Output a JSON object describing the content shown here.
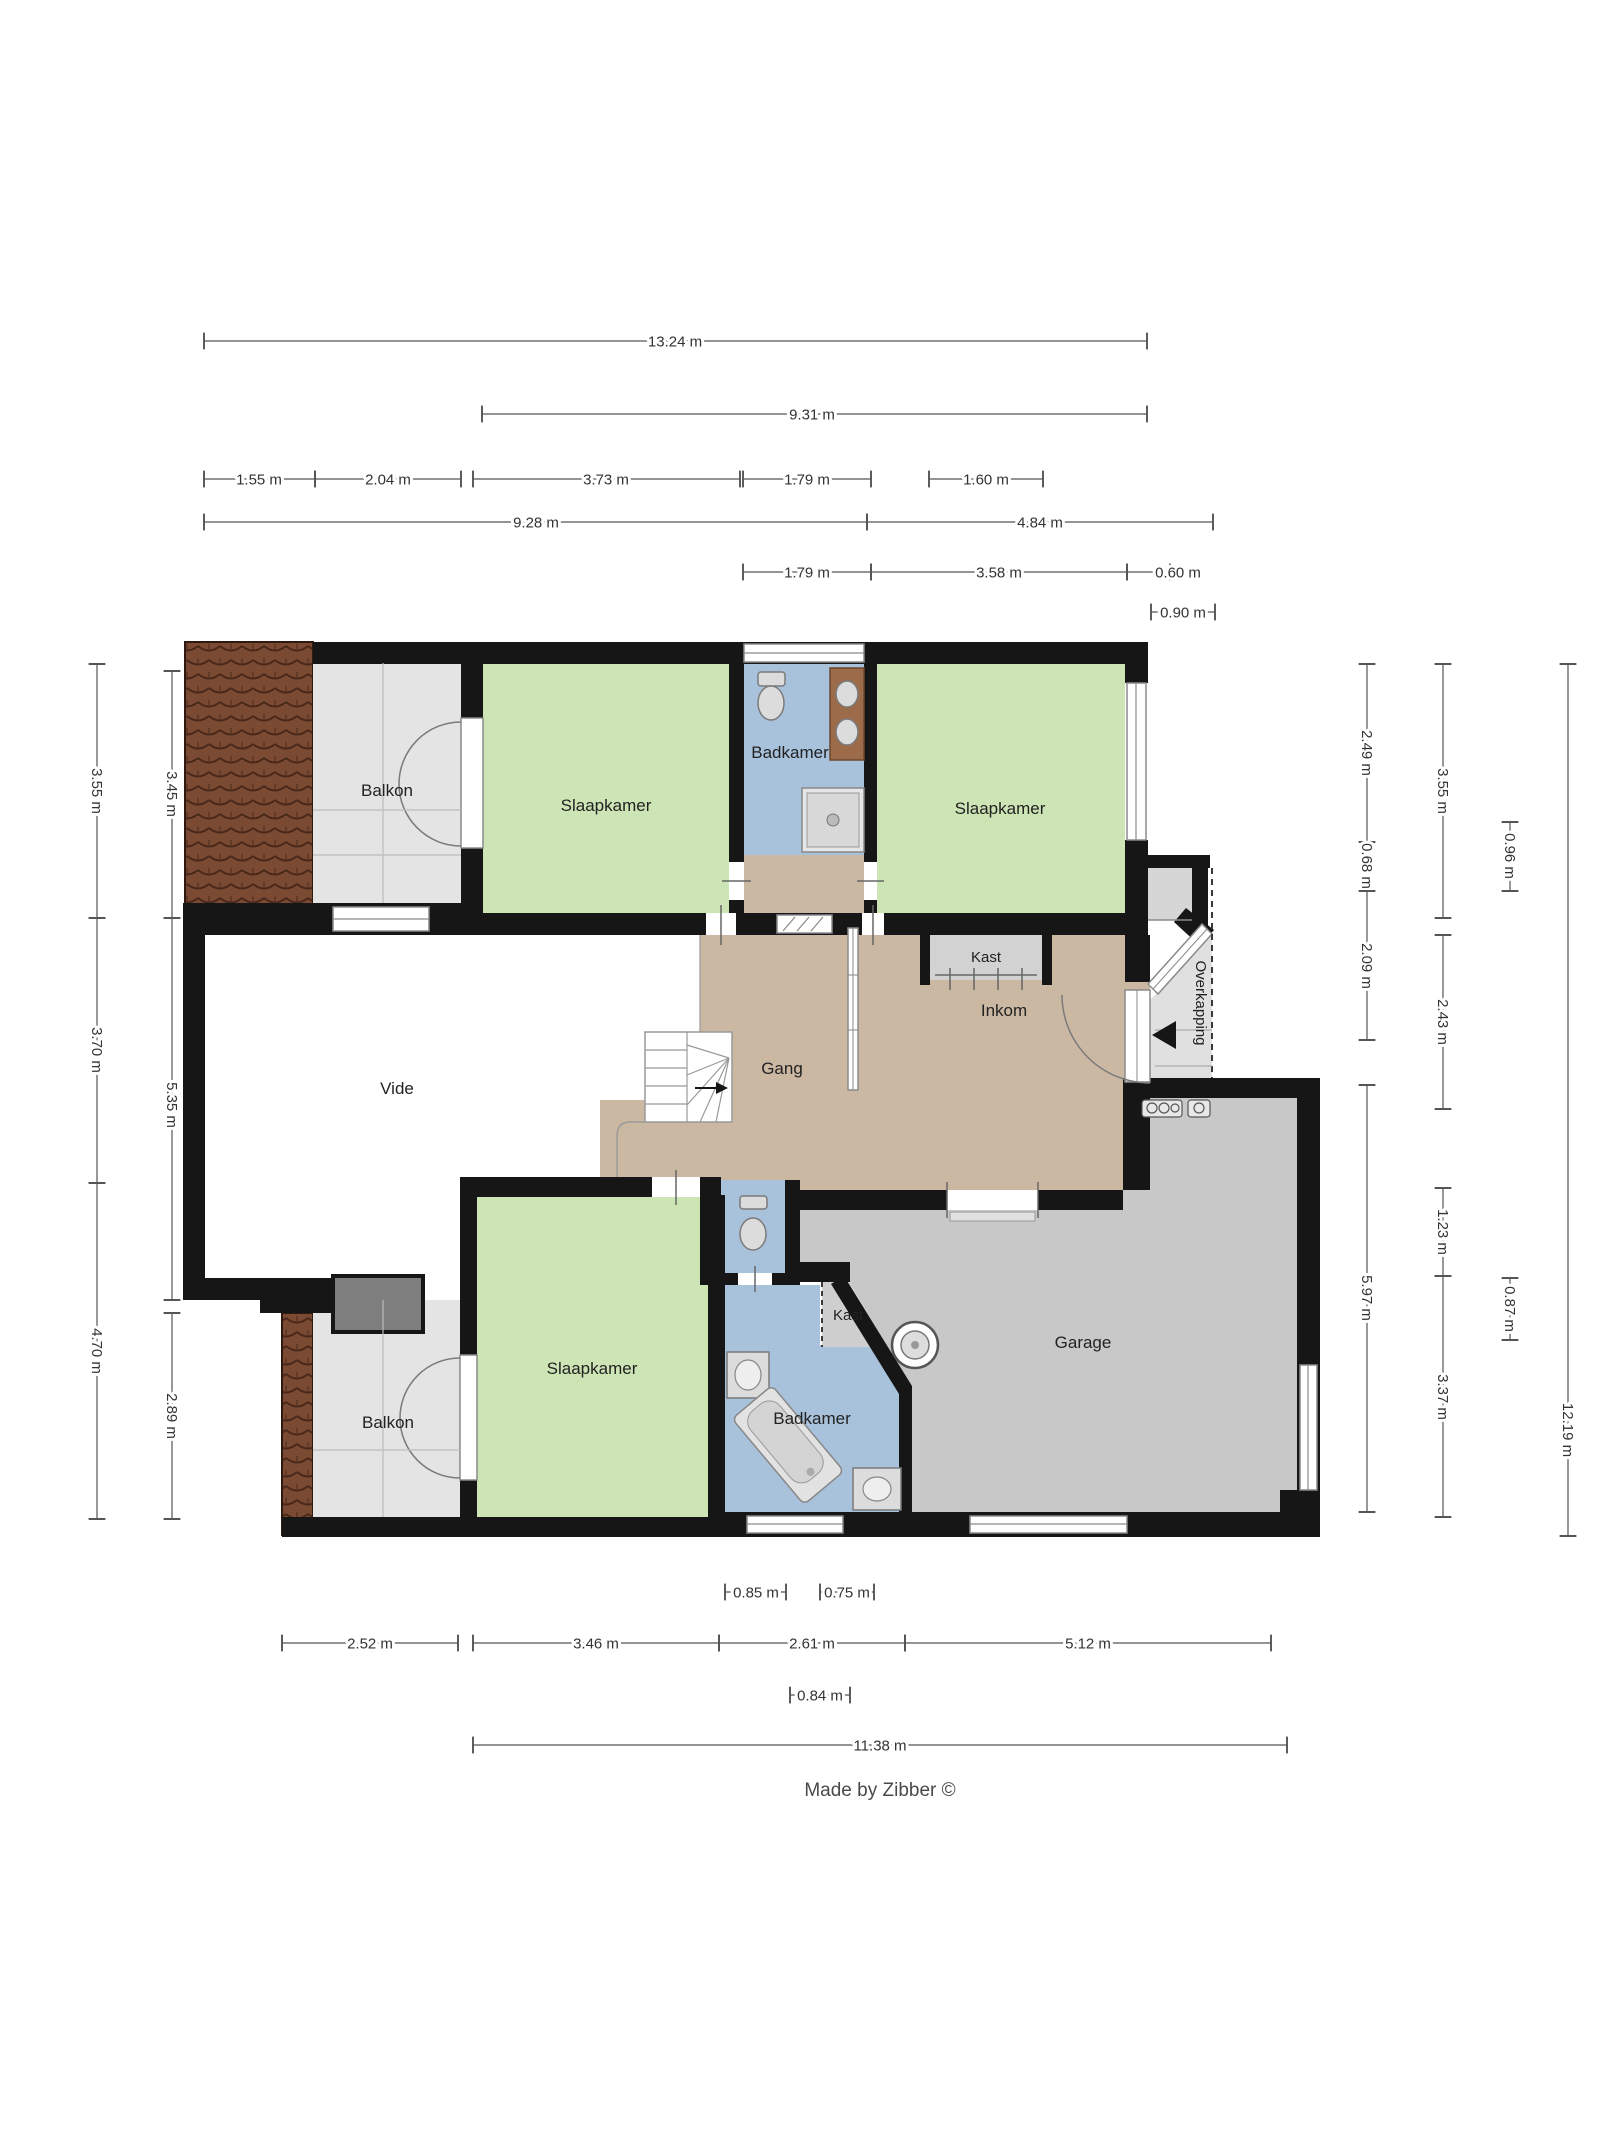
{
  "credit": "Made by Zibber ©",
  "rooms": {
    "balkon_top": "Balkon",
    "slaapkamer_top_left": "Slaapkamer",
    "badkamer_top": "Badkamer",
    "slaapkamer_top_right": "Slaapkamer",
    "kast_inkom": "Kast",
    "inkom": "Inkom",
    "overkapping": "Overkapping",
    "vide": "Vide",
    "gang": "Gang",
    "balkon_bottom": "Balkon",
    "slaapkamer_bottom": "Slaapkamer",
    "kast_garage": "Kast",
    "badkamer_bottom": "Badkamer",
    "garage": "Garage"
  },
  "dimensions": {
    "top": {
      "total": "13.24 m",
      "span_9_31": "9.31 m",
      "seg_1_55": "1.55 m",
      "seg_2_04": "2.04 m",
      "seg_3_73": "3.73 m",
      "seg_1_79": "1.79 m",
      "seg_1_60": "1.60 m",
      "span_9_28": "9.28 m",
      "span_4_84": "4.84 m",
      "seg2_1_79": "1.79 m",
      "seg2_3_58": "3.58 m",
      "seg2_0_60": "0.60 m",
      "seg2_0_90": "0.90 m"
    },
    "left": {
      "outer_3_55": "3.55 m",
      "outer_3_70": "3.70 m",
      "outer_4_70": "4.70 m",
      "inner_3_45": "3.45 m",
      "inner_5_35": "5.35 m",
      "inner_2_89": "2.89 m"
    },
    "right": {
      "inner_2_49": "2.49 m",
      "inner_0_68": "0.68 m",
      "inner_2_09": "2.09 m",
      "inner_5_97": "5.97 m",
      "mid_3_55": "3.55 m",
      "mid_2_43": "2.43 m",
      "mid_1_23": "1.23 m",
      "mid_3_37": "3.37 m",
      "small_0_96": "0.96 m",
      "small_0_87": "0.87 m",
      "total_12_19": "12.19 m"
    },
    "bottom": {
      "small_0_85": "0.85 m",
      "small_0_75": "0.75 m",
      "seg_2_52": "2.52 m",
      "seg_3_46": "3.46 m",
      "seg_2_61": "2.61 m",
      "seg_5_12": "5.12 m",
      "small_0_84": "0.84 m",
      "total_11_38": "11.38 m"
    }
  }
}
